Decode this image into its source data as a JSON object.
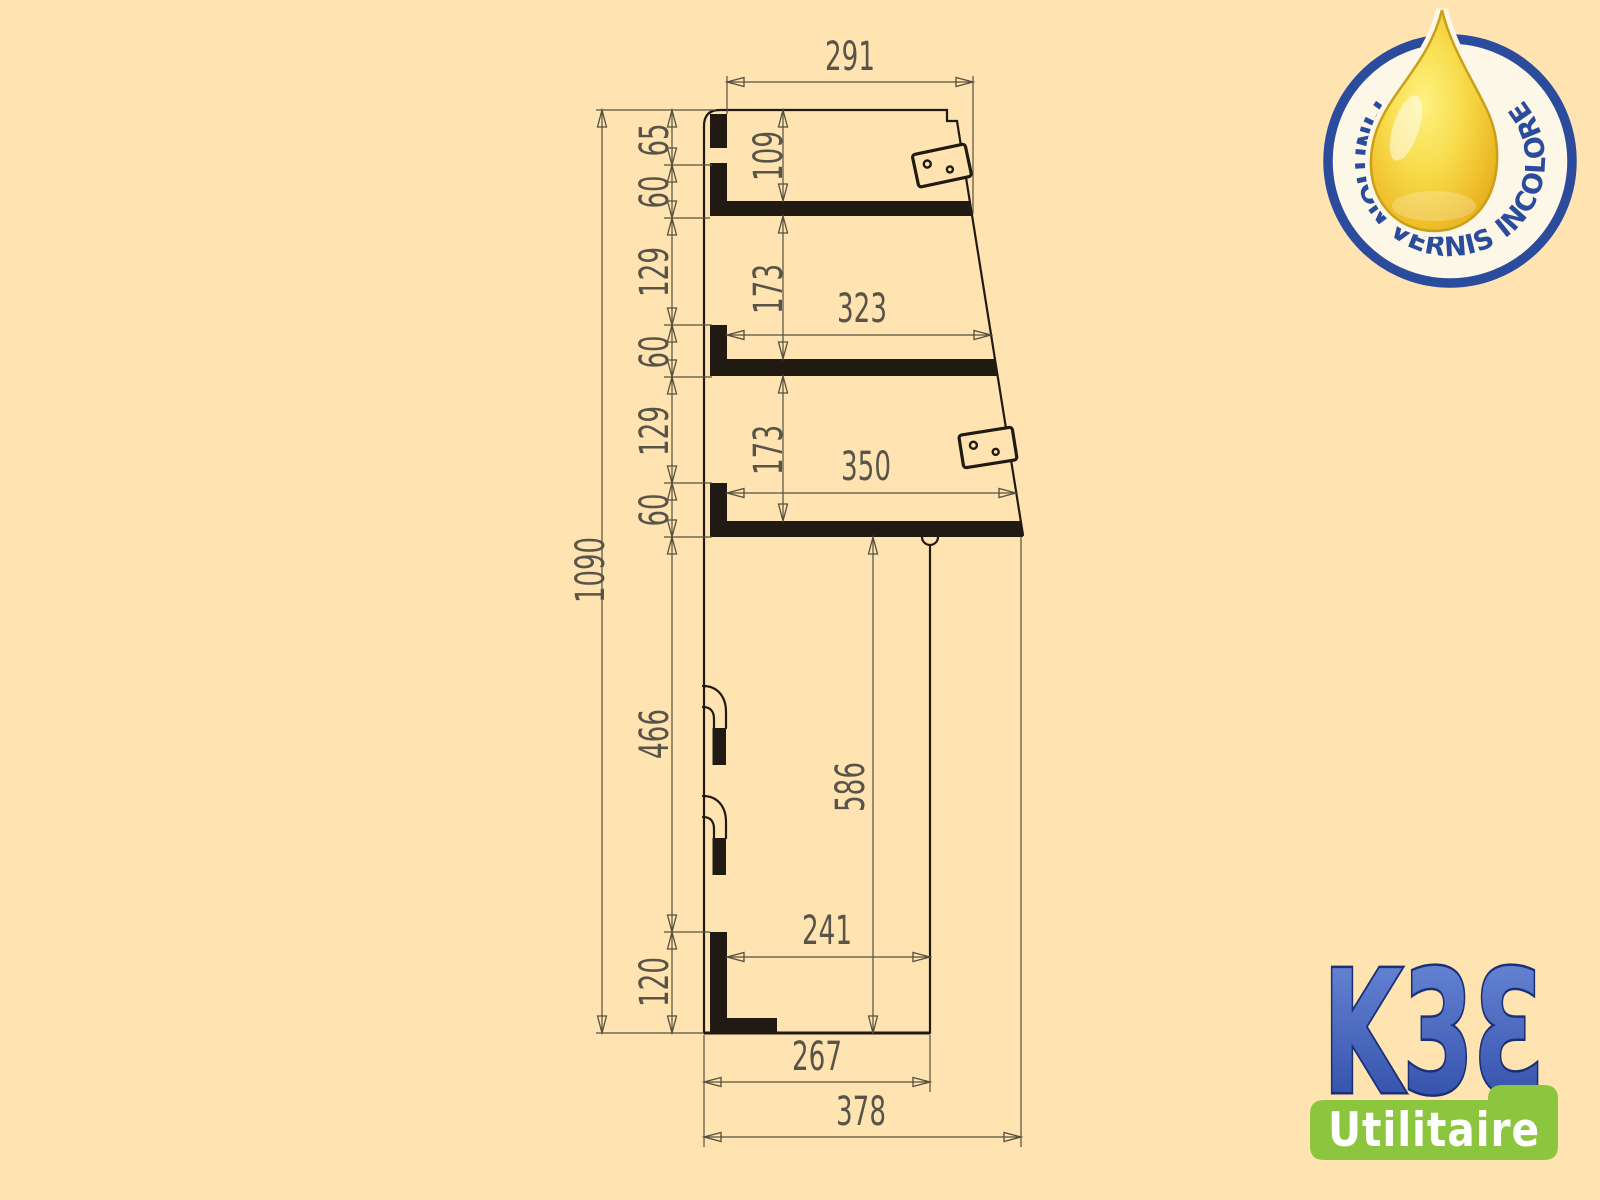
{
  "colors": {
    "background": "#ffe4b1",
    "drawing_line": "#201a12",
    "dimension_line": "#55503f",
    "dimension_text": "#59544a",
    "badge_blue": "#2b4c9c",
    "badge_face": "#fdf7e8",
    "drop_gold": "#efc02c",
    "drop_outline": "#c9a018",
    "brand_blue_top": "#6d8cda",
    "brand_blue_bottom": "#2a47a3",
    "brand_outline": "#1b2f77",
    "banner_green": "#8cc63e",
    "banner_text": "#ffffff"
  },
  "drawing": {
    "dims": {
      "w291": "291",
      "v65": "65",
      "v60a": "60",
      "v129a": "129",
      "v60b": "60",
      "v129b": "129",
      "v60c": "60",
      "v466": "466",
      "v120": "120",
      "v1090": "1090",
      "d109": "109",
      "d173a": "173",
      "d173b": "173",
      "w323": "323",
      "w350": "350",
      "v586": "586",
      "w241": "241",
      "w267": "267",
      "w378": "378"
    }
  },
  "badge": {
    "text": "FINITION VERNIS INCOLORE"
  },
  "brand": {
    "name": "K3Ɛ",
    "tagline": "Utilitaire"
  }
}
